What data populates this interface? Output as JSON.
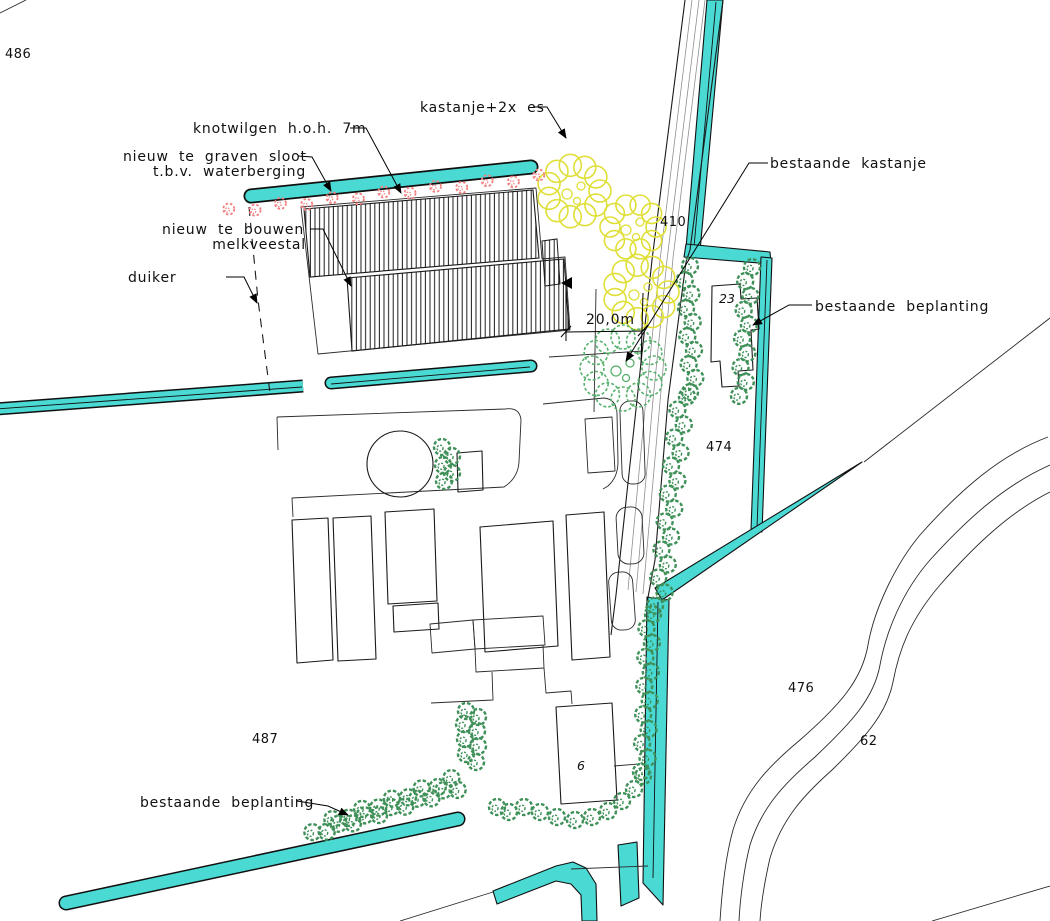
{
  "labels": {
    "knotwilgen": "knotwilgen h.o.h. 7m",
    "sloot_line1": "nieuw te graven sloot",
    "sloot_line2": "t.b.v. waterberging",
    "kastanje_es": "kastanje+2x es",
    "bestaande_kastanje": "bestaande kastanje",
    "bestaande_beplanting_right": "bestaande beplanting",
    "bestaande_beplanting_bottom": "bestaande beplanting",
    "nieuw_te_bouwen_line1": "nieuw te bouwen",
    "nieuw_te_bouwen_line2": "melkveestal",
    "duiker": "duiker",
    "dimension_20m": "20,0m"
  },
  "parcel_numbers": {
    "n486": "486",
    "n410": "410",
    "n474": "474",
    "n476": "476",
    "n487": "487",
    "n62": "62"
  },
  "house_numbers": {
    "n23": "23",
    "n6": "6"
  },
  "colors": {
    "water": "#4bd9d4",
    "tree_green": "#3f9159",
    "kastanje_green": "#58b16d",
    "yellow_tree": "#dfdf38",
    "willow_red": "#f27f7f",
    "line": "#1a1a1a"
  }
}
